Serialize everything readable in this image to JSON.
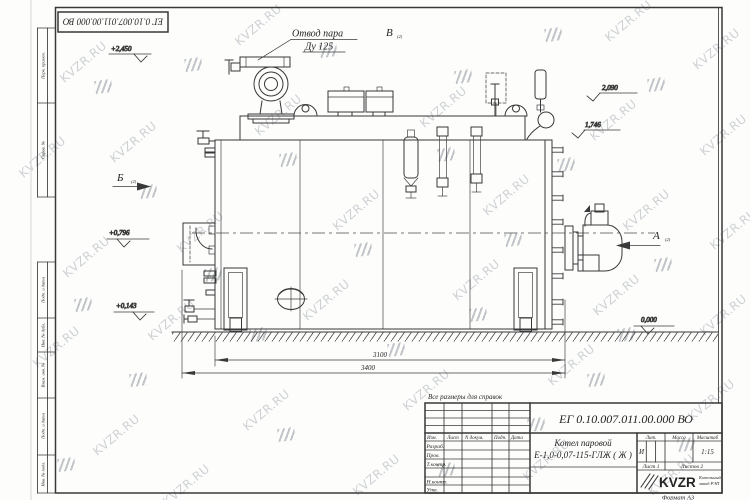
{
  "watermark": {
    "text": "KVZR.RU"
  },
  "frame": {
    "top_stamp": "ЕГ 0.10.007.011.00.000  ВО",
    "margin_labels": [
      "Перв. примен.",
      "Справ. №",
      "Подп. и дата",
      "Инв. № дубл.",
      "Взам. инв. №",
      "Подп. и дата",
      "Инв. № подл."
    ],
    "format_label": "Формат А3"
  },
  "drawing": {
    "callout_steam_line1": "Отвод пара",
    "callout_steam_line2": "Ду 125",
    "note": "Все размеры для справок",
    "views": {
      "a": "А",
      "b": "Б",
      "v": "В",
      "sheet_ref": "(2)"
    },
    "elevations": {
      "top": "+2,450",
      "right_upper": "2,090",
      "right_lower": "1,746",
      "front_mid": "+0,796",
      "front_low": "+0,143",
      "ground": "0,000"
    },
    "dimensions": {
      "body_length": "3100",
      "overall_length": "3400"
    }
  },
  "title_block": {
    "doc_number": "ЕГ 0.10.007.011.00.000  ВО",
    "product_line1": "Котел паровой",
    "product_line2": "Е-1,0-0,07-115-ГЛЖ ( Ж )",
    "cols": {
      "izm": "Изм.",
      "list": "Лист",
      "ndoc": "N докум.",
      "podp": "Подп.",
      "data": "Дата"
    },
    "rows": {
      "razrab": "Разраб.",
      "prov": "Пров.",
      "tkontr": "Т.контр.",
      "nkontr": "Н.контр.",
      "utv": "Утв."
    },
    "lit_header": "Лит.",
    "mass_header": "Масса",
    "scale_header": "Масштаб",
    "lit_value": "И",
    "scale_value": "1:15",
    "sheet": "Лист 1",
    "sheets": "Листов 2",
    "logo": "KVZR",
    "logo_sub1": "Котельный",
    "logo_sub2": "завод РЭП"
  }
}
